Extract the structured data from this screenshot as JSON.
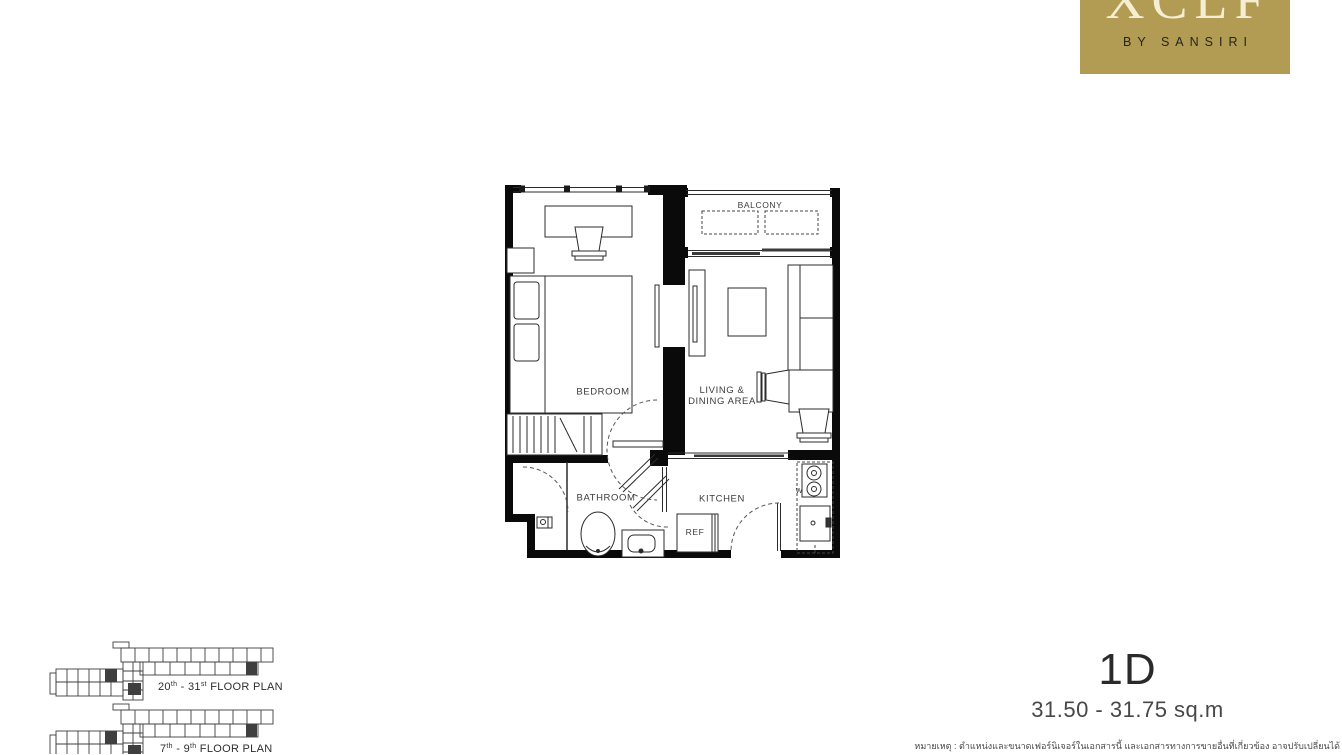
{
  "brand": {
    "wordmark": "XCLF",
    "tagline": "BY SANSIRI"
  },
  "colors": {
    "logo_background": "#b29b52",
    "logo_wordmark": "#f6eed2",
    "logo_tagline": "#23271c",
    "wall": "#0a0a0a",
    "plan_line": "#2b2b2b",
    "label_text": "#3c3c3c"
  },
  "plan_labels": {
    "balcony": "BALCONY",
    "bedroom": "BEDROOM",
    "living_line1": "LIVING &",
    "living_line2": "DINING AREA",
    "bathroom": "BATHROOM",
    "kitchen": "KITCHEN",
    "refrigerator": "REF",
    "washer": "W"
  },
  "unit": {
    "code": "1D",
    "area_range": "31.50 - 31.75 sq.m"
  },
  "key_plans": [
    {
      "from": "20",
      "from_sup": "th",
      "sep": " - ",
      "to": "31",
      "to_sup": "st",
      "suffix": " FLOOR PLAN"
    },
    {
      "from": "7",
      "from_sup": "th",
      "sep": " - ",
      "to": "9",
      "to_sup": "th",
      "suffix": " FLOOR PLAN"
    }
  ],
  "disclaimer": "หมายเหตุ : ตำแหน่งและขนาดเฟอร์นิเจอร์ในเอกสารนี้ และเอกสารทางการขายอื่นที่เกี่ยวข้อง อาจปรับเปลี่ยนได้"
}
